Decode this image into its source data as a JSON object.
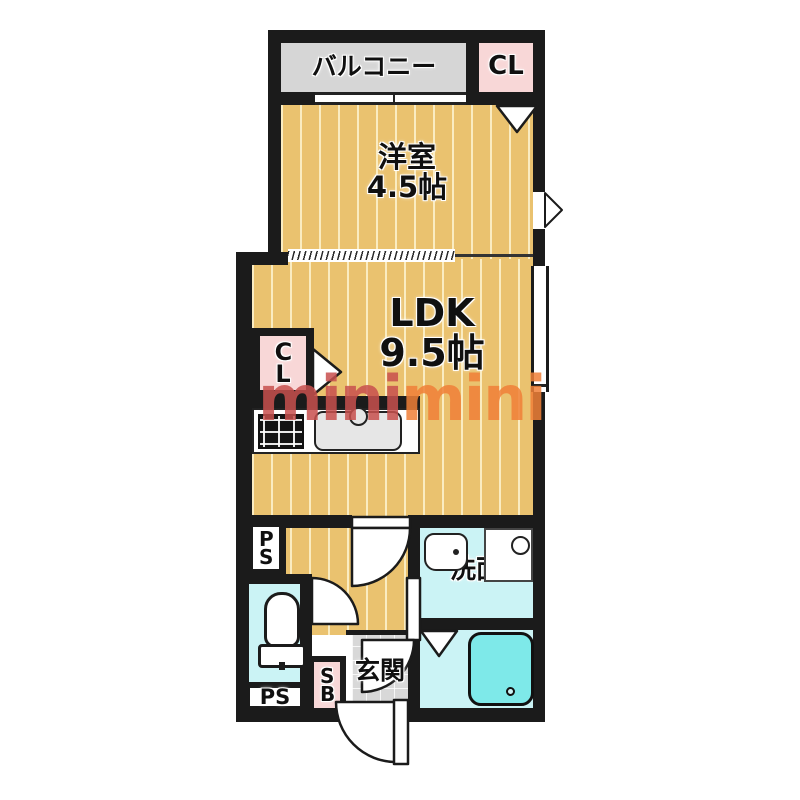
{
  "watermark": {
    "part1": "mini",
    "part2": "mini"
  },
  "rooms": {
    "balcony": "バルコニー",
    "closet_top": "CL",
    "western_room_name": "洋室",
    "western_room_size": "4.5帖",
    "ldk_name": "LDK",
    "ldk_size": "9.5帖",
    "closet_ldk": "CL",
    "washroom": "洗面",
    "entrance": "玄関",
    "shoe_box": "SB",
    "pipe_space_upper": "PS",
    "pipe_space_lower": "PS"
  },
  "icons": {
    "stove": "stove-icon",
    "kitchen_sink": "kitchen-sink-icon",
    "toilet": "toilet-icon",
    "washbasin": "washbasin-icon",
    "washing_machine": "washing-machine-icon",
    "bathtub": "bathtub-icon",
    "door_swing": "door-swing-arc",
    "door_marker": "folding-door-triangle"
  },
  "colors": {
    "wall": "#1b1b1b",
    "floor_wood": "#eac26f",
    "floor_wood_stripe": "#f6e1a4",
    "balcony_gray": "#d6d6d6",
    "closet_pink": "#f8d7d7",
    "wet_area_cyan": "#cbf3f5",
    "bathtub_cyan": "#7ee9e9",
    "entrance_tile": "#d8d8d8",
    "watermark_red": "#c8504e",
    "watermark_orange": "#f08038"
  }
}
